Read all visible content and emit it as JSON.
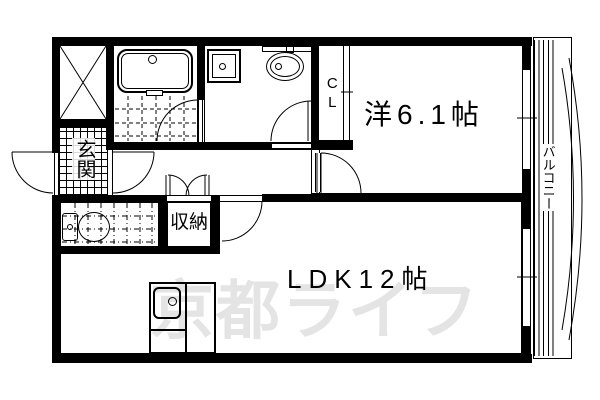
{
  "watermark": {
    "text": "京都ライフ",
    "color": "#e4e4e4"
  },
  "labels": {
    "entrance": "玄関",
    "storage": "収納",
    "closet": "CL",
    "western_room": "洋6.1帖",
    "ldk": "LDK12帖",
    "balcony": "バルコニー"
  },
  "icons": {
    "crossed_box": "x-marked-shaft",
    "bathtub": "bathtub",
    "washer_pan": "washing-machine-pan",
    "basin": "wash-basin",
    "toilet": "toilet",
    "kitchen": "kitchen-sink-counter"
  },
  "colors": {
    "line": "#000000",
    "background": "#ffffff",
    "watermark": "#e4e4e4"
  }
}
